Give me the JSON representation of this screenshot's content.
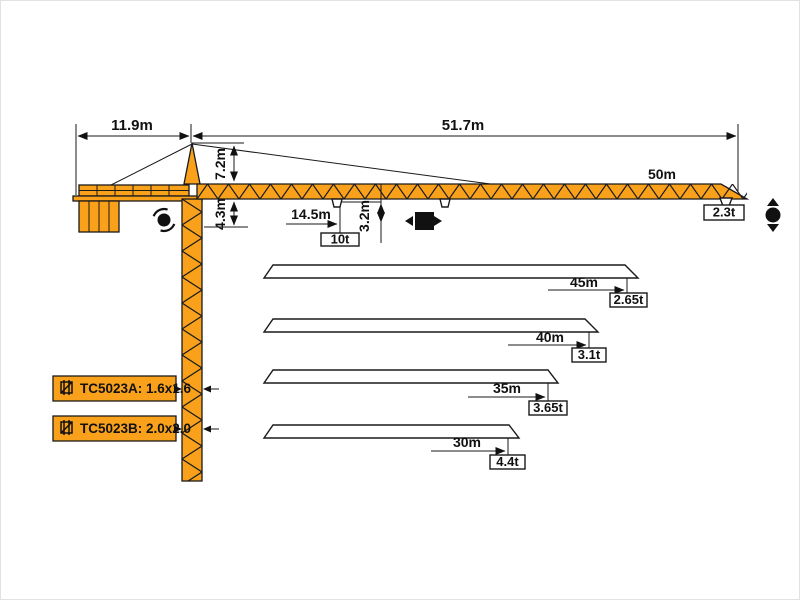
{
  "colors": {
    "crane_yellow": "#F9A11B",
    "outline": "#1a1a1a"
  },
  "dimensions": {
    "counter_jib_length": "11.9m",
    "jib_working_length": "51.7m",
    "tower_head_height": "7.2m",
    "jib_underside_height": "4.3m",
    "trolley_radius": "14.5m",
    "hook_clearance": "3.2m",
    "max_load": "10t"
  },
  "main_jib": {
    "length": "50m",
    "tip_load": "2.3t"
  },
  "jib_variants": [
    {
      "length": "45m",
      "tip_load": "2.65t"
    },
    {
      "length": "40m",
      "tip_load": "3.1t"
    },
    {
      "length": "35m",
      "tip_load": "3.65t"
    },
    {
      "length": "30m",
      "tip_load": "4.4t"
    }
  ],
  "mast_sections": [
    {
      "label": "TC5023A: 1.6x1.6"
    },
    {
      "label": "TC5023B: 2.0x2.0"
    }
  ]
}
